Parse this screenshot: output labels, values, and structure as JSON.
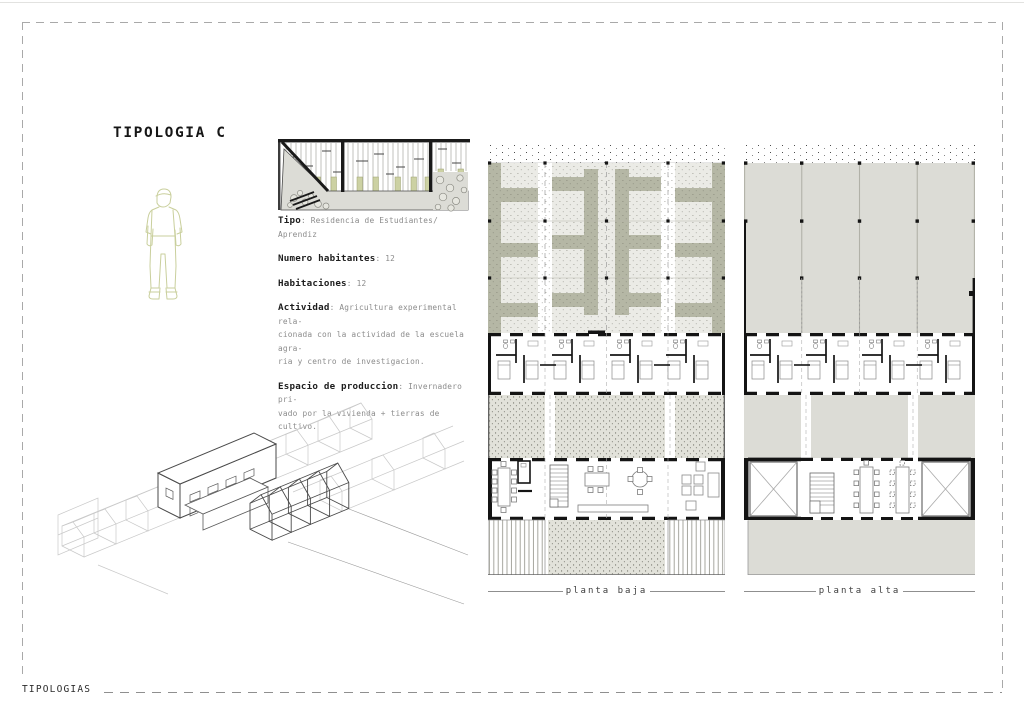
{
  "page": {
    "title": "TIPOLOGIA C",
    "footer_label": "TIPOLOGIAS"
  },
  "info": {
    "tipo": {
      "label": "Tipo",
      "value": ": Residencia de Estudiantes/ Aprendiz"
    },
    "habitantes": {
      "label": "Numero habitantes",
      "value": ": 12"
    },
    "habitaciones": {
      "label": "Habitaciones",
      "value": ": 12"
    },
    "actividad": {
      "label": "Actividad",
      "value": ": Agricultura experimental rela-\ncionada con la actividad de la escuela agra-\nria y centro de investigacion."
    },
    "produccion": {
      "label": "Espacio de produccion",
      "value": ": Invernadero pri-\nvado por la vivienda + tierras de cultivo."
    }
  },
  "plans": {
    "left_label": "planta baja",
    "right_label": "planta alta"
  },
  "icons": {
    "figure": "standing-person-outline",
    "section": "greenhouse-section-drawing",
    "axon": "axonometric-row-housing"
  },
  "colors": {
    "olive_band": "#b5b7a5",
    "figure_olive": "#c9cf9c",
    "stipple_bg": "#ebebe6",
    "courtyard_bg": "#e2e2da",
    "solid_grey": "#dcdcd6",
    "wall_black": "#141414",
    "dash_border": "#a9a9a9"
  }
}
